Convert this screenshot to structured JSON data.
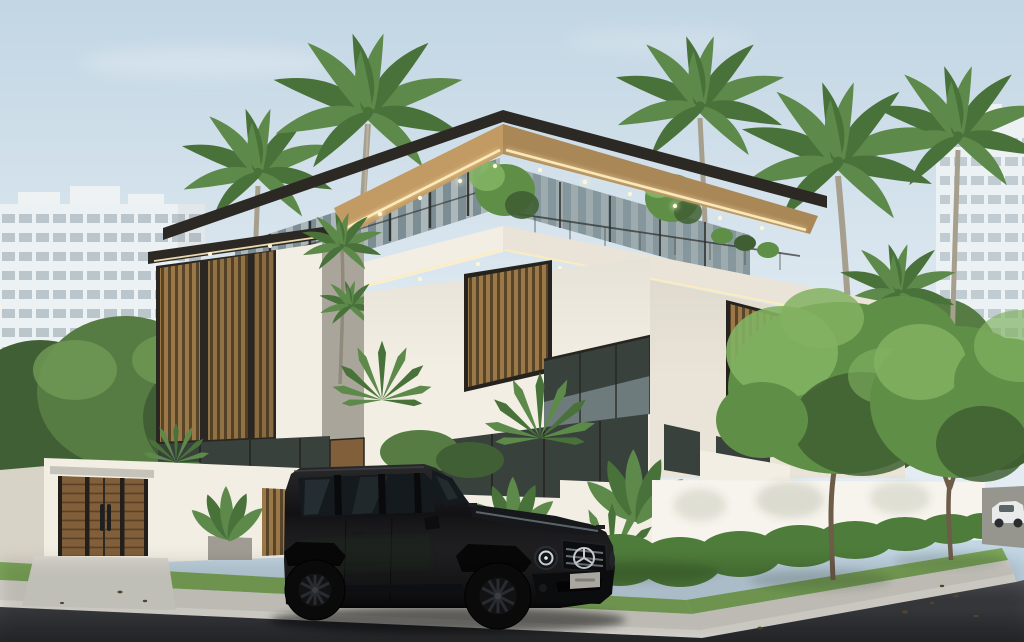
{
  "scene": {
    "setting": "Photorealistic daytime architectural rendering of a modern tropical villa street corner",
    "objects": [
      "three-story modern villa with flat overhanging roofs",
      "warm LED strip lighting and recessed soffit downlights under eaves",
      "vertical wood louver facade panels",
      "floor-to-ceiling glass with sheer curtains",
      "glass balustrade balconies and rooftop terrace planting",
      "white perimeter wall with wooden entry gate",
      "concrete driveway apron",
      "black Mercedes G-Class SUV parked on street",
      "trimmed green hedge along boundary wall",
      "street trees on grass verge",
      "coconut palm trees and fan palms",
      "white high-rise apartment buildings in background",
      "asphalt road, concrete sidewalk and curb",
      "distant white car on cross street",
      "clear pale blue sky"
    ]
  },
  "visible_text": [],
  "palette": {
    "sky_top": "#c2d6e4",
    "sky_low": "#e7eef3",
    "bldg_face": "#eef2f3",
    "bldg_window": "#b9c6cf",
    "foliage_dark": "#415f35",
    "foliage_mid": "#567c44",
    "foliage_light": "#6f9854",
    "tree_mid": "#5f8f47",
    "tree_light": "#82b262",
    "tree_dark": "#3f5f33",
    "palm_frond": "#5d8a4a",
    "palm_frond_dark": "#49723a",
    "palm_trunk": "#a69f8e",
    "wall_lit": "#f2eee3",
    "wall_mid": "#e9e4d7",
    "wall_shade": "#d8d3c7",
    "wall_dark": "#bcb7ab",
    "fascia_dark": "#2c2925",
    "soffit_wood": "#c29a63",
    "led_glow": "#ffedbb",
    "louver_wood": "#9a7848",
    "louver_dark": "#32302b",
    "frame_dark": "#26251f",
    "glass_dark": "#39413d",
    "glass_mid": "#7c8e94",
    "curtain": "#eae7dc",
    "door_wood": "#815f3a",
    "planter_concrete": "#a19c93",
    "hedge_green": "#4e7c3a",
    "grass_green": "#7da75a",
    "sidewalk": "#d6d4cb",
    "sidewalk_shade": "#c2c0b7",
    "curb_light": "#e5e3da",
    "road_light": "#53555a",
    "road_mid": "#3c3e42",
    "road_dark": "#27282b",
    "car_black": "#0a0a0c",
    "car_window": "#141a1d",
    "car_reflect": "#4d5a62",
    "rim_dark": "#141518",
    "spoke_gray": "#2e3135",
    "chrome_soft": "#ccd2d7",
    "plate_gray": "#c0beb5",
    "white_car": "#e9ebea",
    "trunk_brown": "#6d5c48"
  }
}
